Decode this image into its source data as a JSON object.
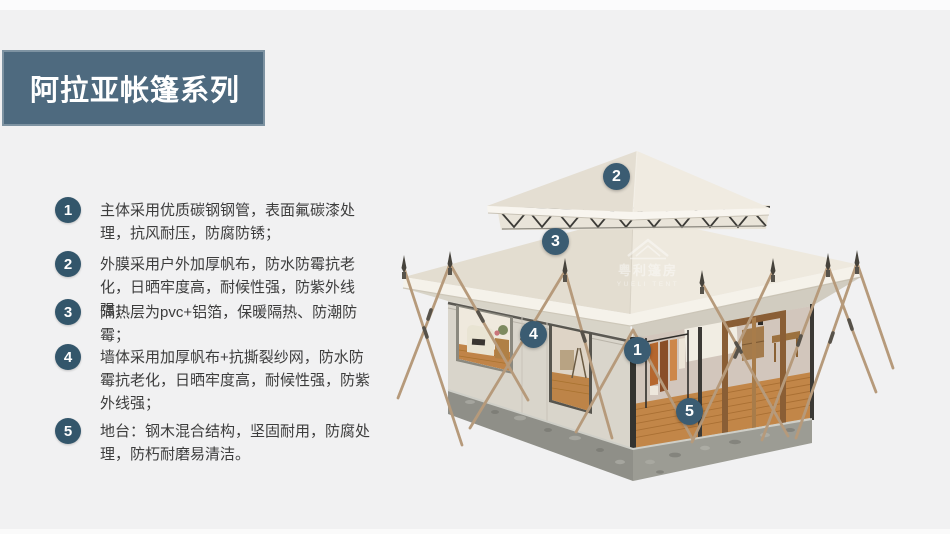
{
  "header": {
    "title": "阿拉亚帐篷系列"
  },
  "features": {
    "items": [
      {
        "number": "1",
        "text": "主体采用优质碳钢钢管，表面氟碳漆处理，抗风耐压，防腐防锈；"
      },
      {
        "number": "2",
        "text": "外膜采用户外加厚帆布，防水防霉抗老化，日晒牢度高，耐候性强，防紫外线强；"
      },
      {
        "number": "3",
        "text": "隔热层为pvc+铝箔，保暖隔热、防潮防霉；"
      },
      {
        "number": "4",
        "text": "墙体采用加厚帆布+抗撕裂纱网，防水防霉抗老化，日晒牢度高，耐候性强，防紫外线强；"
      },
      {
        "number": "5",
        "text": "地台：钢木混合结构，坚固耐用，防腐处理，防朽耐磨易清洁。"
      }
    ]
  },
  "tent": {
    "callouts": [
      {
        "number": "1"
      },
      {
        "number": "2"
      },
      {
        "number": "3"
      },
      {
        "number": "4"
      },
      {
        "number": "5"
      }
    ],
    "watermark": {
      "cn": "粤利篷房",
      "en": "YUELI TENT"
    }
  },
  "colors": {
    "accent_badge": "#33566b",
    "banner": "#4e6a7f",
    "background": "#f1f1f2",
    "roof_light": "#eee9de",
    "roof_shade": "#e3ddd0",
    "wall": "#d9d5cb",
    "platform": "#8f8f88",
    "rope": "#b69a7b",
    "wood_floor": "#c28648"
  }
}
